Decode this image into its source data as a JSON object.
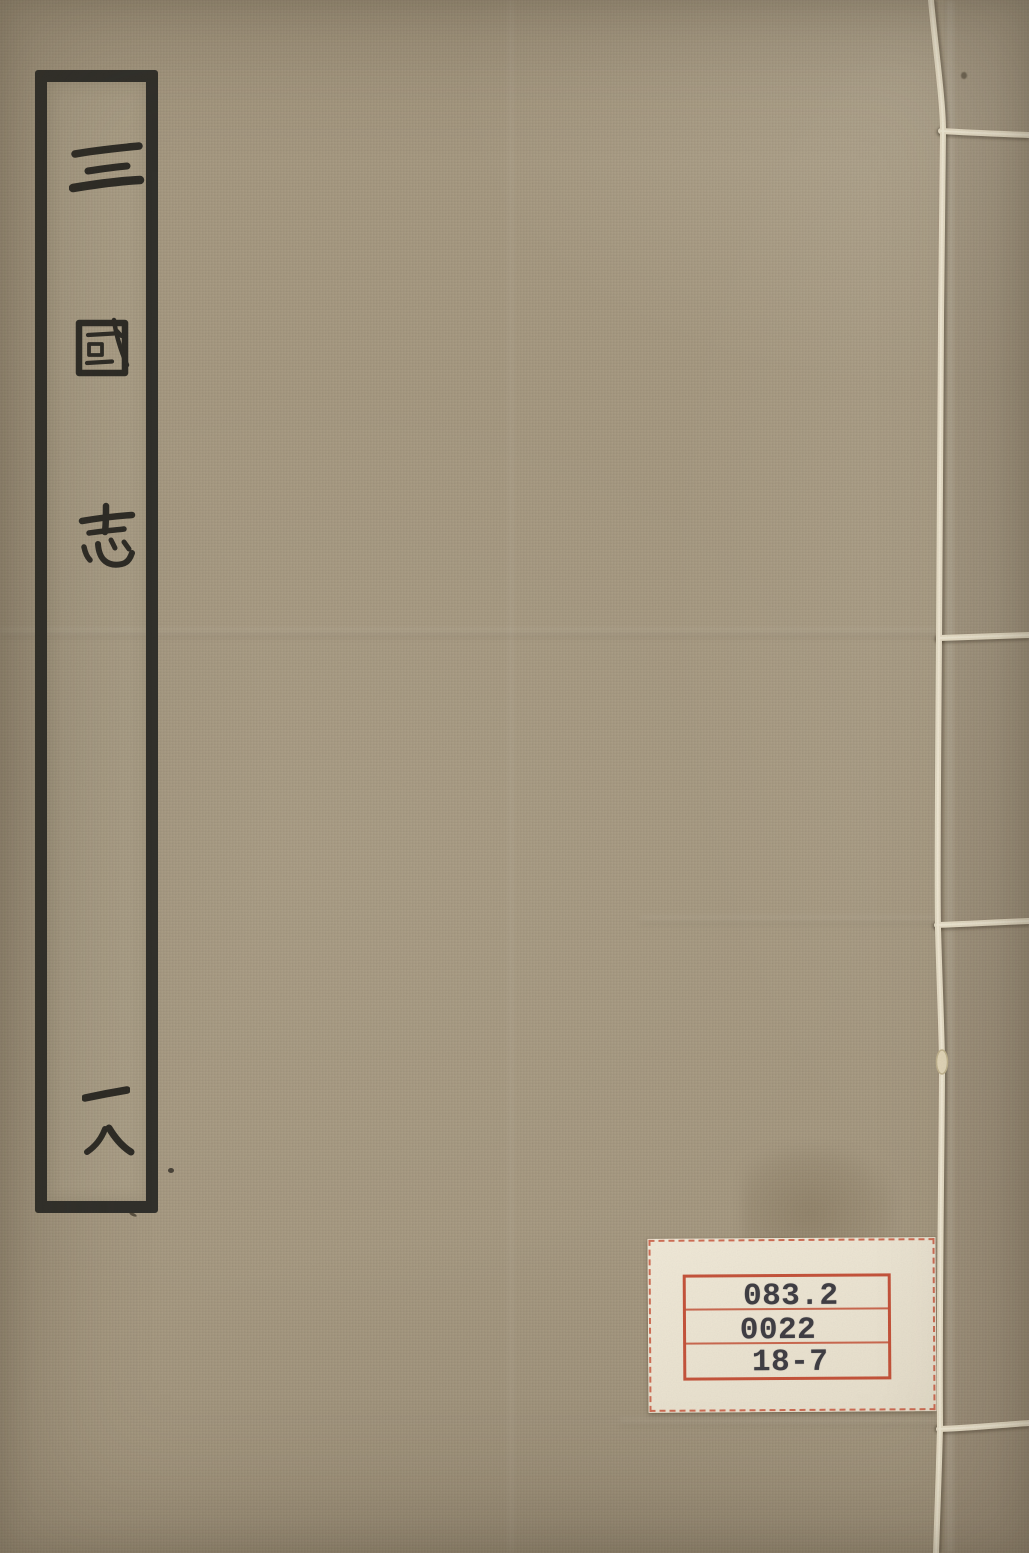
{
  "book": {
    "title": "三國志",
    "title_chars": [
      "三",
      "國",
      "志"
    ],
    "volume_label": "一八",
    "volume_chars": [
      "一",
      "八"
    ]
  },
  "call_label": {
    "line1": "083.2",
    "line2": "0022",
    "line3": "18-7"
  },
  "colors": {
    "cover_fabric": "#a59880",
    "ink_black": "#2e2c26",
    "title_frame": "#31302b",
    "binding_thread": "#e9e0c9",
    "call_label_paper": "#ebe4d3",
    "call_label_red": "#c04a31",
    "call_label_ink": "#403e44"
  }
}
